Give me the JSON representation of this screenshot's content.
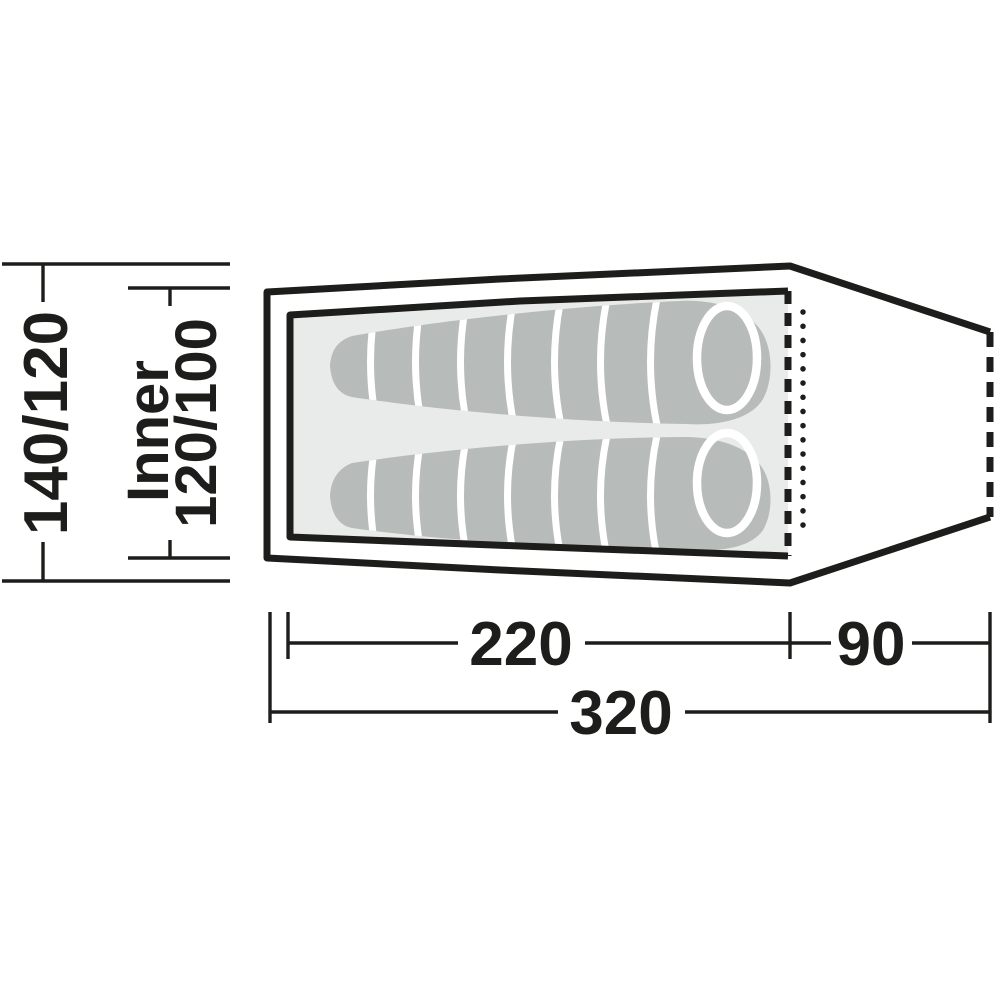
{
  "diagram": {
    "type": "tent-floor-plan-top-view",
    "dimension_labels": {
      "width_outer": "140/120",
      "inner_word": "Inner",
      "width_inner": "120/100",
      "length_inner": "220",
      "length_porch": "90",
      "length_total": "320"
    },
    "colors": {
      "outline": "#1d1d1b",
      "inner_floor": "#e9eaea",
      "sleeping_bag": "#b7bbba",
      "bag_divider": "#ffffff",
      "background": "#ffffff"
    }
  }
}
